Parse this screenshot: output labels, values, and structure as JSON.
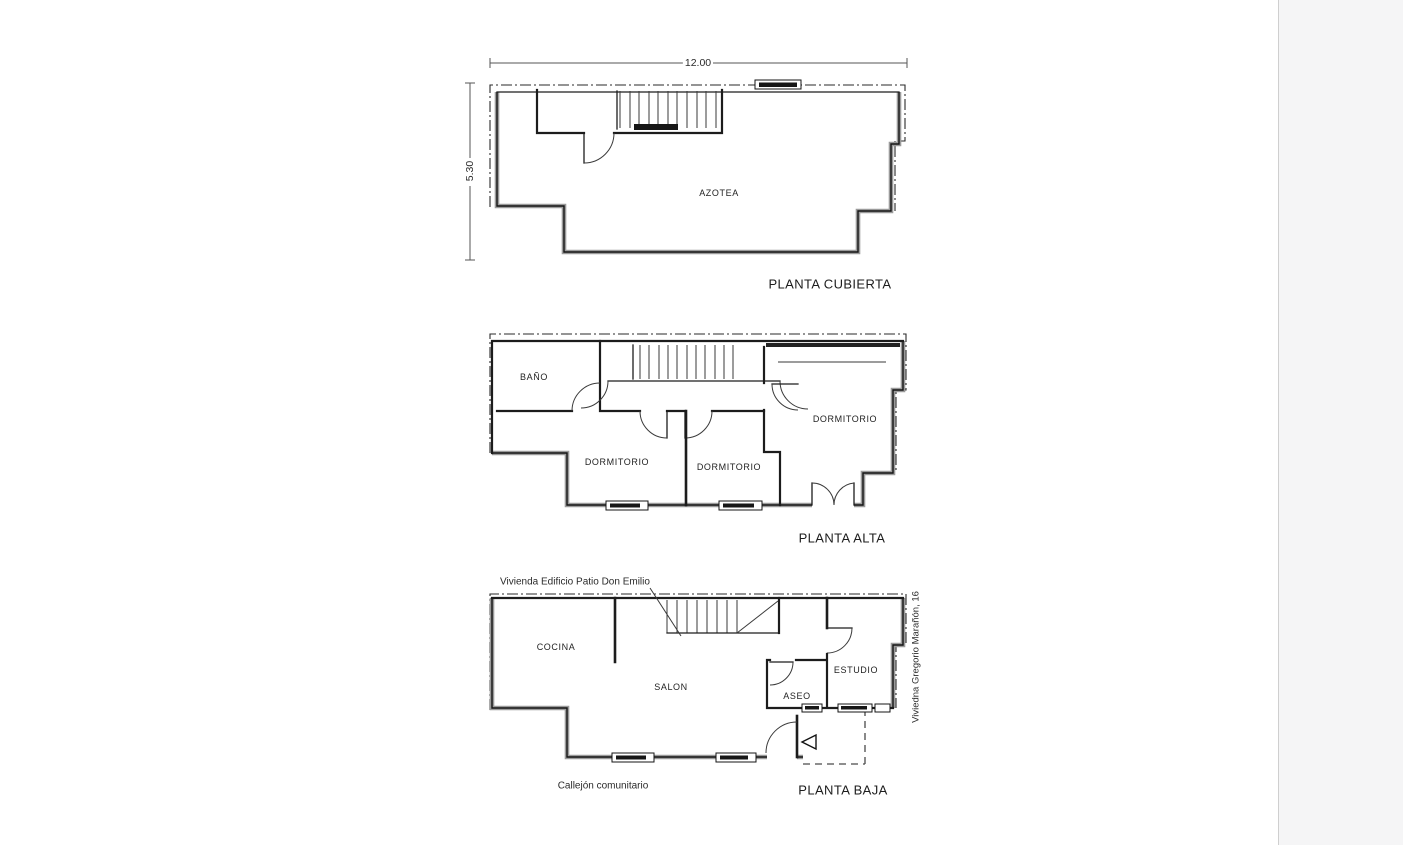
{
  "document": {
    "type": "architectural-floor-plans",
    "background": "#ffffff",
    "line_color": "#1c1c1c",
    "heavy_wall_halo": "#9a9a9a",
    "side_panel_color": "#f5f5f6"
  },
  "dimensions": {
    "width": "12.00",
    "height": "5.30"
  },
  "plans": {
    "cubierta": {
      "title": "PLANTA CUBIERTA",
      "rooms": {
        "azotea": "AZOTEA"
      }
    },
    "alta": {
      "title": "PLANTA ALTA",
      "rooms": {
        "bano": "BAÑO",
        "dormitorio1": "DORMITORIO",
        "dormitorio2": "DORMITORIO",
        "dormitorio3": "DORMITORIO"
      }
    },
    "baja": {
      "title": "PLANTA BAJA",
      "rooms": {
        "cocina": "COCINA",
        "salon": "SALON",
        "aseo": "ASEO",
        "estudio": "ESTUDIO"
      },
      "annotations": {
        "building": "Vivienda Edificio Patio Don Emilio",
        "alley": "Callejón comunitario",
        "address": "Viviedna Gregorio Marañón, 16"
      }
    }
  }
}
